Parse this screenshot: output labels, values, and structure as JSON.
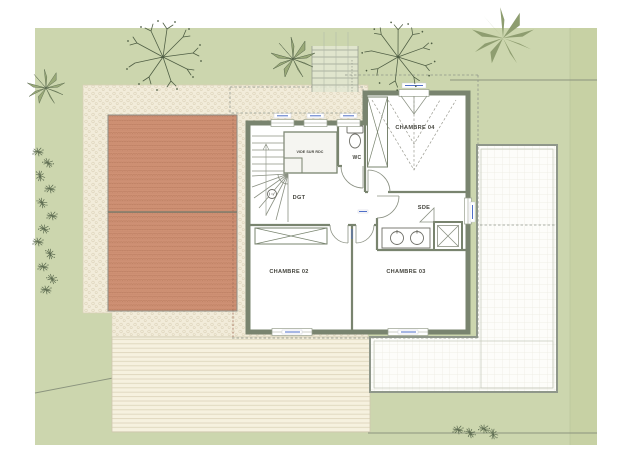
{
  "plan": {
    "kind": "architectural floor plan (upper floor)",
    "rooms": [
      {
        "id": "chambre-04",
        "label": "CHAMBRE 04"
      },
      {
        "id": "wc",
        "label": "WC"
      },
      {
        "id": "vide",
        "label": "VIDE SUR RDC"
      },
      {
        "id": "dgt",
        "label": "DGT"
      },
      {
        "id": "sde",
        "label": "SDE"
      },
      {
        "id": "chambre-02",
        "label": "CHAMBRE 02"
      },
      {
        "id": "chambre-03",
        "label": "CHAMBRE 03"
      }
    ],
    "colors": {
      "lawn": "#ccd6ae",
      "lawn_band": "#c7d1a4",
      "gravel": "#f2ecda",
      "roof_tile": "#cf9174",
      "roof_tile_line": "#aa6d52",
      "deck": "#f6f1df",
      "terrace": "#fdfdfa",
      "wall": "#79846f",
      "dashed_line": "#8f958a",
      "dimension_label": "#4f6fc8",
      "tree_stroke": "#4f5e44",
      "palm_fill": "#8e9d70"
    }
  }
}
